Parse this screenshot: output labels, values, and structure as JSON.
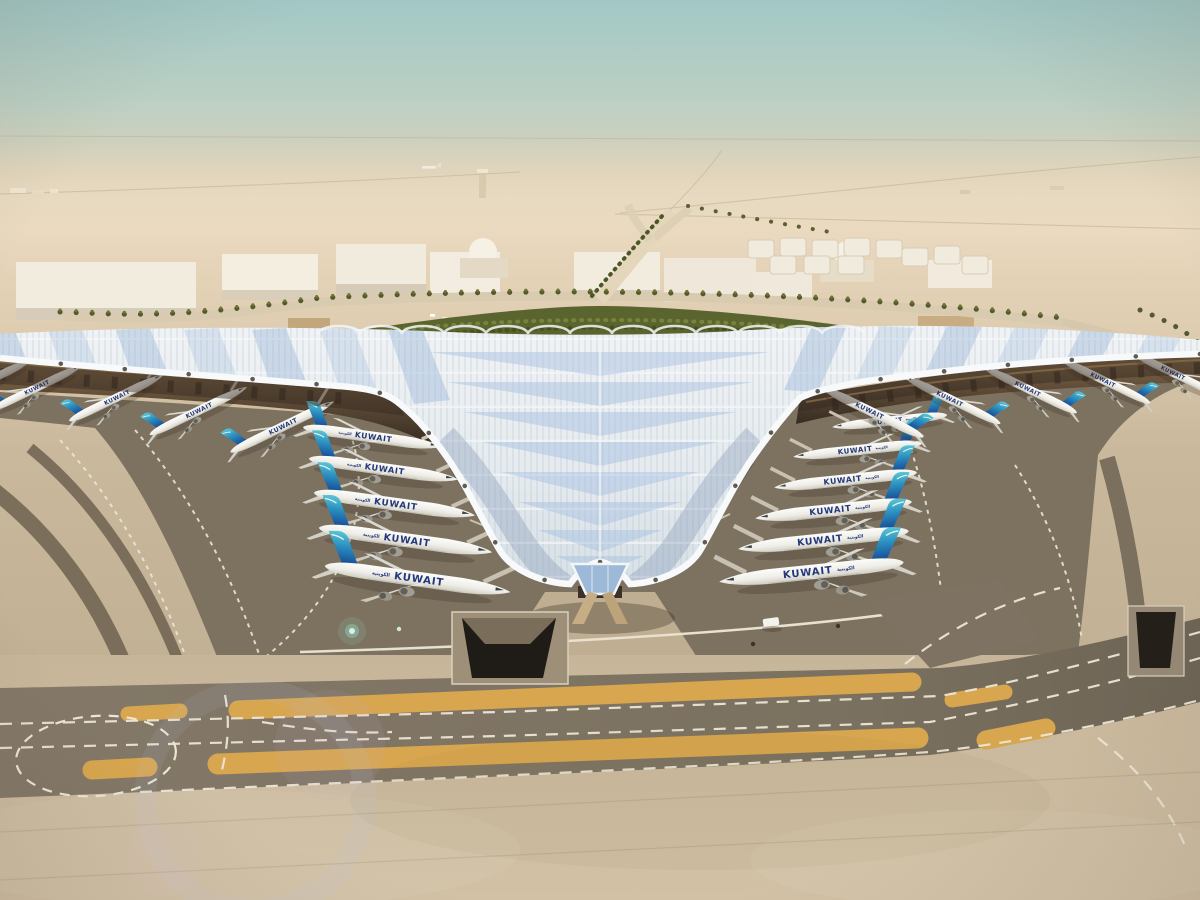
{
  "image": {
    "type": "aerial architectural rendering",
    "subject": "Y-shaped airport terminal with ribbed silver trefoil canopy roof",
    "environment": "flat desert under a hazy teal-to-beige sky",
    "features": [
      "aircraft parked nose-in along both edges of the central roof valley and along both wings",
      "curved palm-lined approach roads and a green landscaped belt behind the terminal",
      "white low-rise support buildings, domes and a fuel-tank farm on the horizon",
      "dark asphalt apron horseshoe with dotted white lead-in lines",
      "foreground taxiway with ochre shoulder strips and dashed white centerlines",
      "underground road portals cut into the apron",
      "soft lens-flare spots in the lower left"
    ]
  },
  "livery": {
    "title": "KUWAIT",
    "arabic_mark": "الكويتية",
    "tail_gradient": [
      "#59c6d4",
      "#174a94"
    ]
  },
  "aircraft_counts": {
    "inner_left_row": 5,
    "inner_right_row": 6,
    "left_wing_row": 5,
    "right_wing_row": 5
  },
  "palette": {
    "sky_top": "#a3c9c7",
    "sky_horizon": "#e9d8bd",
    "desert_sand": "#e2d1b5",
    "roof_silver": "#e9edf0",
    "roof_skylight_blue": "#9cb8da",
    "canopy_underside": "#8a6f4e",
    "apron_concrete": "#c7b69a",
    "apron_asphalt": "#7d7260",
    "taxiway_asphalt": "#80755f",
    "shoulder_ochre": "#d7a64f",
    "marking_white": "#ece6d4",
    "landscape_green": "#5a642f",
    "aircraft_fuselage": "#f4f3ef"
  }
}
